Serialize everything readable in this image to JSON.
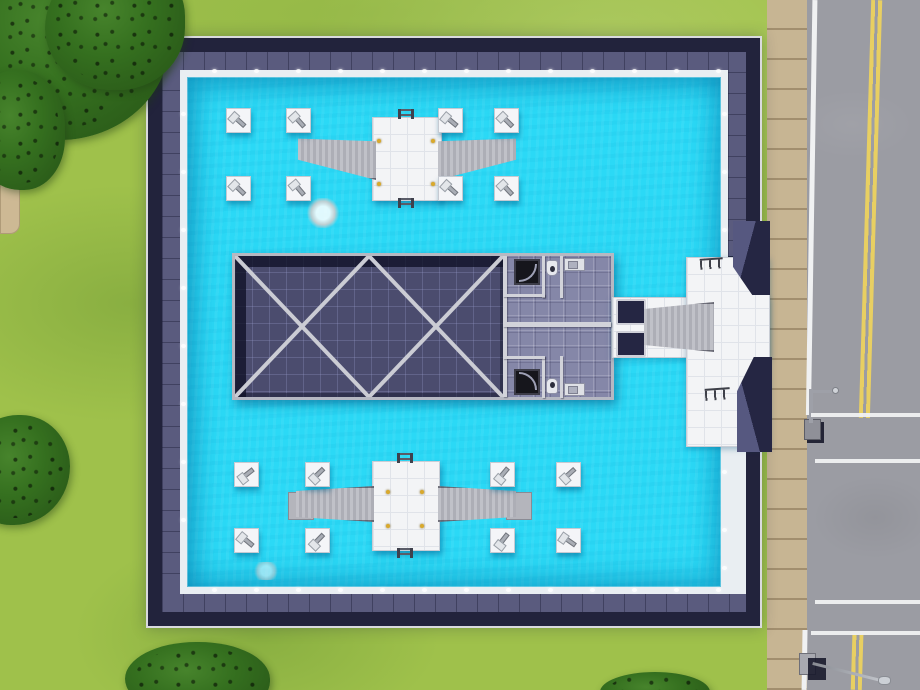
{
  "scene": {
    "domain": "game",
    "game_style": "life-simulation top-down build view",
    "view": "aerial view of a community pool lot beside a road",
    "visible_text": "none",
    "elements": [
      "grass lot with trees",
      "concrete footpath",
      "navy-roofed pool building",
      "cyan swimming pool water",
      "16 diving-board platforms",
      "two slide platforms with water slides",
      "central roof with X cross-bracing",
      "two mirrored restrooms with showers, toilets and sinks",
      "street entrance plaza with ramp and awnings",
      "sidewalk",
      "asphalt road with double yellow center line",
      "intersection stop lines",
      "two street lamps"
    ]
  },
  "colors": {
    "grass": "#9fc14b",
    "tree": "#35701f",
    "path": "#cdb994",
    "water": "#2bd9f6",
    "pool_edge": "#e9eef2",
    "roof_slate": "#5a5b7e",
    "roof_navy": "#22233c",
    "outer_line": "#d9dade",
    "floor_dark": "#4b4c6e",
    "beam": "#cbccd4",
    "bath_floor": "#8587a8",
    "wall": "#d2d3da",
    "shower": "#16161c",
    "fixture": "#e7e8ee",
    "deck": "#f3f4f6",
    "deck_line": "#e0e3e9",
    "ramp": "#b7b8bf",
    "awning": "#252643",
    "awning_panel": "#565880",
    "board": "#a9adb5",
    "gold": "#d9a92c",
    "road": "#9b9ca3",
    "sidewalk": "#c7b593",
    "line_white": "#f0f1f2",
    "line_yellow": "#e8cf62"
  },
  "terrain": {
    "path": {
      "x": 0,
      "y": 148,
      "w": 20,
      "h": 86
    },
    "trees": [
      {
        "x": -45,
        "y": -55,
        "w": 215,
        "h": 195,
        "r": "48% 52% 55% 45%"
      },
      {
        "x": 45,
        "y": -40,
        "w": 140,
        "h": 130,
        "r": "55% 45% 50% 50%"
      },
      {
        "x": -30,
        "y": 70,
        "w": 95,
        "h": 120,
        "r": "50% 50% 45% 55%"
      },
      {
        "x": -35,
        "y": 415,
        "w": 105,
        "h": 110,
        "r": "52% 48% 55% 45%"
      },
      {
        "x": 125,
        "y": 642,
        "w": 145,
        "h": 75,
        "r": "50% 50% 48% 52%"
      },
      {
        "x": 600,
        "y": 672,
        "w": 110,
        "h": 40,
        "r": "50% 50% 45% 45%"
      }
    ]
  },
  "pool": {
    "lights": {
      "top": {
        "y": 69,
        "xs": [
          212,
          254,
          296,
          338,
          380,
          422,
          464,
          506,
          548,
          590,
          632,
          674,
          716
        ]
      },
      "bottom": {
        "y": 588,
        "xs": [
          212,
          254,
          296,
          338,
          380,
          422,
          464,
          506,
          548,
          590,
          632,
          674,
          716
        ]
      },
      "left": {
        "x": 181,
        "ys": [
          112,
          170,
          228,
          286,
          344,
          402,
          460,
          518
        ]
      },
      "right": {
        "x": 722,
        "ys": [
          112,
          170,
          228,
          470,
          528,
          566
        ]
      }
    },
    "diving_platforms": [
      {
        "x": 226,
        "y": 108,
        "a": 42
      },
      {
        "x": 286,
        "y": 108,
        "a": 48
      },
      {
        "x": 438,
        "y": 108,
        "a": 40
      },
      {
        "x": 494,
        "y": 108,
        "a": 45
      },
      {
        "x": 226,
        "y": 176,
        "a": 44
      },
      {
        "x": 286,
        "y": 176,
        "a": 50
      },
      {
        "x": 438,
        "y": 176,
        "a": 42
      },
      {
        "x": 494,
        "y": 176,
        "a": 47
      },
      {
        "x": 234,
        "y": 462,
        "a": -38
      },
      {
        "x": 305,
        "y": 462,
        "a": -44
      },
      {
        "x": 490,
        "y": 462,
        "a": -50
      },
      {
        "x": 556,
        "y": 462,
        "a": -42
      },
      {
        "x": 234,
        "y": 528,
        "a": 40
      },
      {
        "x": 305,
        "y": 528,
        "a": -46
      },
      {
        "x": 490,
        "y": 528,
        "a": -52
      },
      {
        "x": 556,
        "y": 528,
        "a": 35
      }
    ],
    "platform_dots": [
      {
        "x": 377,
        "y": 139
      },
      {
        "x": 377,
        "y": 182
      },
      {
        "x": 431,
        "y": 139
      },
      {
        "x": 431,
        "y": 182
      },
      {
        "x": 386,
        "y": 490
      },
      {
        "x": 420,
        "y": 490
      },
      {
        "x": 386,
        "y": 524
      },
      {
        "x": 420,
        "y": 524
      }
    ],
    "ladders": [
      {
        "x": 398,
        "y": 109
      },
      {
        "x": 398,
        "y": 198
      },
      {
        "x": 397,
        "y": 453
      },
      {
        "x": 397,
        "y": 548
      }
    ],
    "splashes": [
      {
        "x": 306,
        "y": 198,
        "w": 34,
        "h": 30,
        "o": 0.9
      },
      {
        "x": 252,
        "y": 562,
        "w": 28,
        "h": 18,
        "o": 0.55
      }
    ]
  },
  "restrooms": {
    "walls": [
      {
        "x": 503,
        "y": 256,
        "w": 4,
        "h": 141
      },
      {
        "x": 503,
        "y": 322,
        "w": 108,
        "h": 5
      },
      {
        "x": 542,
        "y": 256,
        "w": 3,
        "h": 42
      },
      {
        "x": 560,
        "y": 256,
        "w": 3,
        "h": 42
      },
      {
        "x": 503,
        "y": 294,
        "w": 42,
        "h": 3
      },
      {
        "x": 542,
        "y": 356,
        "w": 3,
        "h": 42
      },
      {
        "x": 560,
        "y": 356,
        "w": 3,
        "h": 42
      },
      {
        "x": 503,
        "y": 356,
        "w": 42,
        "h": 3
      }
    ],
    "showers": [
      {
        "x": 514,
        "y": 259,
        "w": 26,
        "h": 26,
        "flip": false
      },
      {
        "x": 514,
        "y": 369,
        "w": 26,
        "h": 26,
        "flip": true
      }
    ],
    "toilets": [
      {
        "x": 546,
        "y": 260,
        "w": 12,
        "h": 16,
        "flip": false
      },
      {
        "x": 546,
        "y": 378,
        "w": 12,
        "h": 16,
        "flip": true
      }
    ],
    "sinks": [
      {
        "x": 564,
        "y": 258,
        "w": 21,
        "h": 13
      },
      {
        "x": 564,
        "y": 383,
        "w": 21,
        "h": 13
      }
    ]
  },
  "entrance": {
    "racks": [
      {
        "x": 700,
        "y": 258,
        "w": 23,
        "h": 11
      },
      {
        "x": 705,
        "y": 388,
        "w": 25,
        "h": 12
      }
    ]
  },
  "road": {
    "stop_lines": [
      {
        "x": 811,
        "y": 413,
        "w": 109,
        "h": 4
      },
      {
        "x": 815,
        "y": 459,
        "w": 105,
        "h": 4
      },
      {
        "x": 815,
        "y": 600,
        "w": 105,
        "h": 4
      },
      {
        "x": 811,
        "y": 631,
        "w": 109,
        "h": 4
      }
    ]
  }
}
